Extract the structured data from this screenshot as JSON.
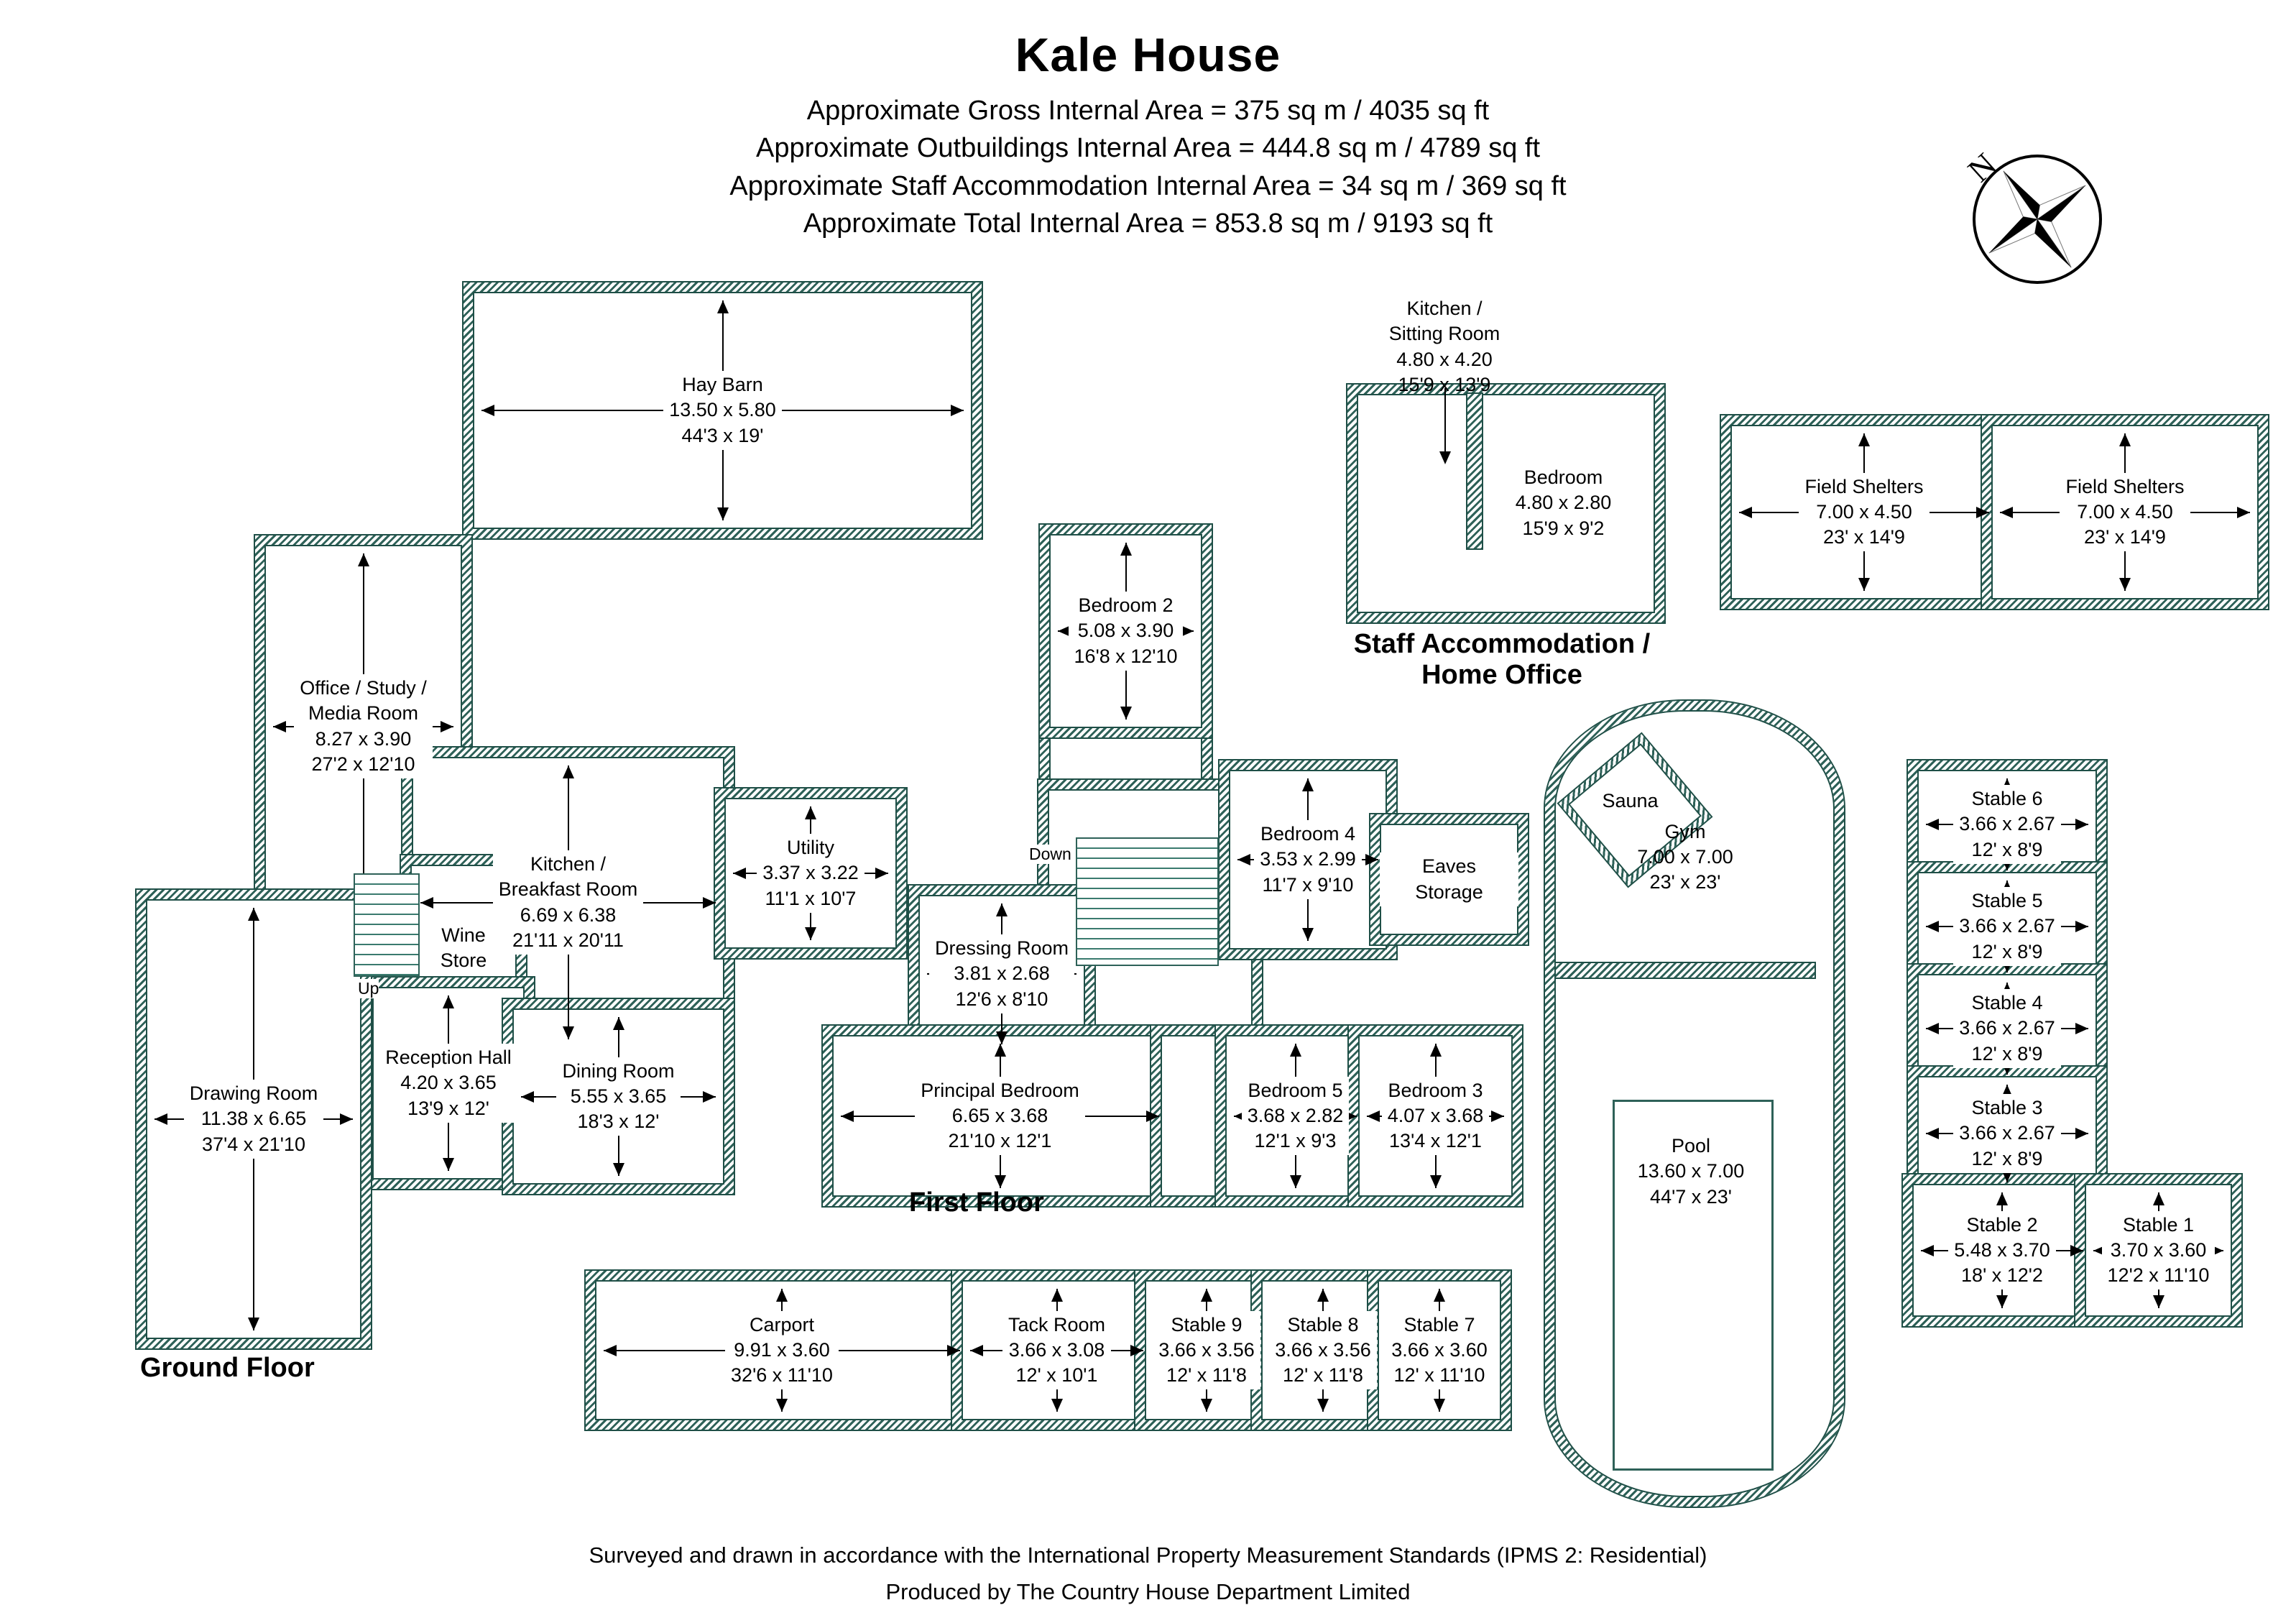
{
  "header": {
    "title": "Kale House",
    "area_lines": [
      "Approximate Gross Internal Area = 375 sq m / 4035 sq ft",
      "Approximate Outbuildings Internal Area = 444.8 sq m / 4789 sq ft",
      "Approximate Staff Accommodation Internal Area = 34 sq m / 369 sq ft",
      "Approximate Total Internal Area = 853.8 sq m / 9193 sq ft"
    ]
  },
  "compass": {
    "north_label": "N"
  },
  "outbuildings": {
    "hay_barn": {
      "name": "Hay Barn",
      "metric": "13.50 x 5.80",
      "imperial": "44'3 x 19'"
    },
    "field_shelter_1": {
      "name": "Field Shelters",
      "metric": "7.00 x 4.50",
      "imperial": "23' x 14'9"
    },
    "field_shelter_2": {
      "name": "Field Shelters",
      "metric": "7.00 x 4.50",
      "imperial": "23' x 14'9"
    }
  },
  "staff_accommodation": {
    "section_label": "Staff Accommodation /\nHome Office",
    "kitchen_sitting_room": {
      "name": "Kitchen /\nSitting Room",
      "metric": "4.80 x 4.20",
      "imperial": "15'9 x 13'9"
    },
    "bedroom": {
      "name": "Bedroom",
      "metric": "4.80 x 2.80",
      "imperial": "15'9 x 9'2"
    }
  },
  "ground_floor": {
    "section_label": "Ground Floor",
    "office_study_media": {
      "name": "Office / Study /\nMedia Room",
      "metric": "8.27 x 3.90",
      "imperial": "27'2 x 12'10"
    },
    "kitchen_breakfast": {
      "name": "Kitchen /\nBreakfast Room",
      "metric": "6.69 x 6.38",
      "imperial": "21'11 x 20'11"
    },
    "wine_store": {
      "name": "Wine\nStore"
    },
    "utility": {
      "name": "Utility",
      "metric": "3.37 x 3.22",
      "imperial": "11'1 x 10'7"
    },
    "reception_hall": {
      "name": "Reception Hall",
      "metric": "4.20 x 3.65",
      "imperial": "13'9 x 12'"
    },
    "dining_room": {
      "name": "Dining Room",
      "metric": "5.55 x 3.65",
      "imperial": "18'3 x 12'"
    },
    "drawing_room": {
      "name": "Drawing Room",
      "metric": "11.38 x 6.65",
      "imperial": "37'4 x 21'10"
    },
    "stairs_label": "Up"
  },
  "first_floor": {
    "section_label": "First Floor",
    "bedroom_2": {
      "name": "Bedroom 2",
      "metric": "5.08 x 3.90",
      "imperial": "16'8 x 12'10"
    },
    "bedroom_4": {
      "name": "Bedroom 4",
      "metric": "3.53 x 2.99",
      "imperial": "11'7 x 9'10"
    },
    "eaves_storage": {
      "name": "Eaves Storage"
    },
    "dressing_room": {
      "name": "Dressing Room",
      "metric": "3.81 x 2.68",
      "imperial": "12'6 x 8'10"
    },
    "principal_bedroom": {
      "name": "Principal Bedroom",
      "metric": "6.65 x 3.68",
      "imperial": "21'10 x 12'1"
    },
    "bedroom_5": {
      "name": "Bedroom 5",
      "metric": "3.68 x 2.82",
      "imperial": "12'1 x 9'3"
    },
    "bedroom_3": {
      "name": "Bedroom 3",
      "metric": "4.07 x 3.68",
      "imperial": "13'4 x 12'1"
    },
    "stairs_label": "Down"
  },
  "pool_house": {
    "sauna": {
      "name": "Sauna"
    },
    "gym": {
      "name": "Gym",
      "metric": "7.00 x 7.00",
      "imperial": "23' x 23'"
    },
    "pool": {
      "name": "Pool",
      "metric": "13.60 x 7.00",
      "imperial": "44'7 x 23'"
    }
  },
  "stables": {
    "stable_6": {
      "name": "Stable 6",
      "metric": "3.66 x 2.67",
      "imperial": "12' x 8'9"
    },
    "stable_5": {
      "name": "Stable 5",
      "metric": "3.66 x 2.67",
      "imperial": "12' x 8'9"
    },
    "stable_4": {
      "name": "Stable 4",
      "metric": "3.66 x 2.67",
      "imperial": "12' x 8'9"
    },
    "stable_3": {
      "name": "Stable 3",
      "metric": "3.66 x 2.67",
      "imperial": "12' x 8'9"
    },
    "stable_2": {
      "name": "Stable 2",
      "metric": "5.48 x 3.70",
      "imperial": "18' x 12'2"
    },
    "stable_1": {
      "name": "Stable 1",
      "metric": "3.70 x 3.60",
      "imperial": "12'2 x 11'10"
    },
    "carport": {
      "name": "Carport",
      "metric": "9.91 x 3.60",
      "imperial": "32'6 x 11'10"
    },
    "tack_room": {
      "name": "Tack Room",
      "metric": "3.66 x 3.08",
      "imperial": "12' x 10'1"
    },
    "stable_9": {
      "name": "Stable 9",
      "metric": "3.66 x 3.56",
      "imperial": "12' x 11'8"
    },
    "stable_8": {
      "name": "Stable 8",
      "metric": "3.66 x 3.56",
      "imperial": "12' x 11'8"
    },
    "stable_7": {
      "name": "Stable 7",
      "metric": "3.66 x 3.60",
      "imperial": "12' x 11'10"
    }
  },
  "footer": {
    "line1": "Surveyed and drawn in accordance with the International Property Measurement Standards (IPMS 2: Residential)",
    "line2": "Produced by The Country House Department Limited"
  },
  "colors": {
    "wall_hatch": "#2e6158",
    "wall_outline": "#1f4f47",
    "text": "#000000"
  }
}
